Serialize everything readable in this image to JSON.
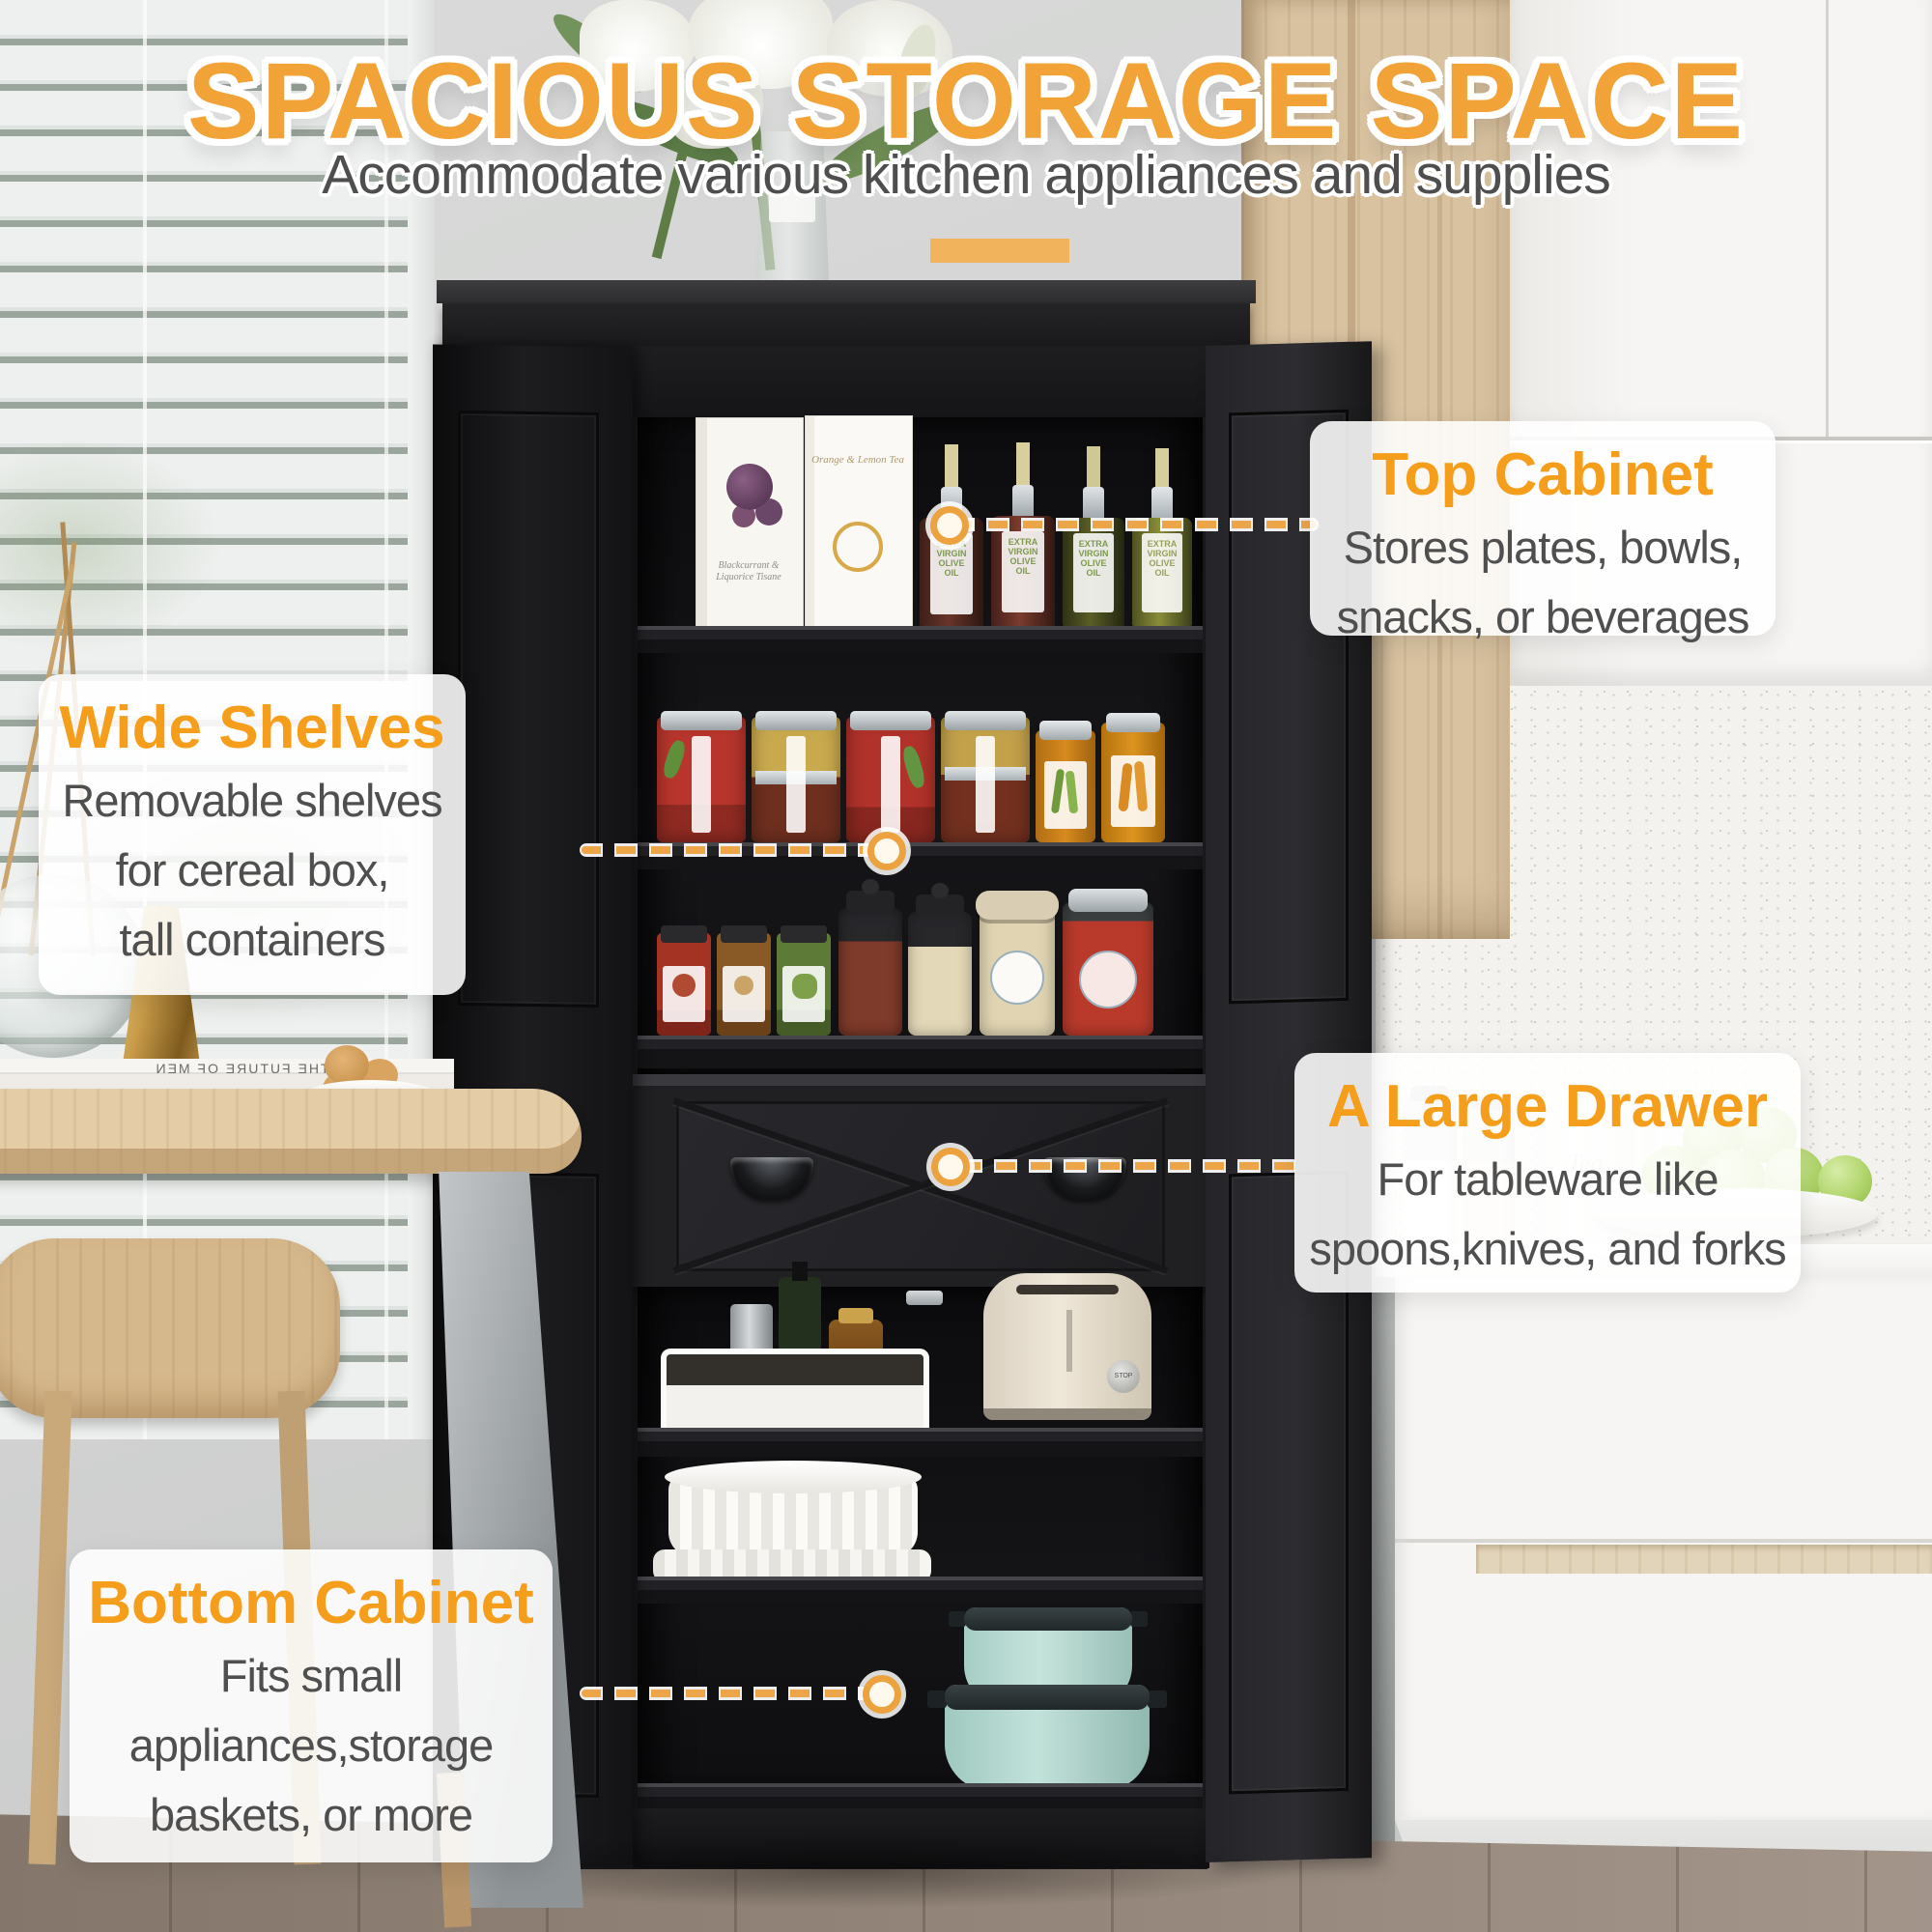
{
  "header": {
    "title": "SPACIOUS STORAGE SPACE",
    "subtitle": "Accommodate various kitchen appliances and supplies"
  },
  "callouts": {
    "top_cabinet": {
      "title": "Top Cabinet",
      "lines": [
        "Stores plates, bowls,",
        "snacks, or beverages"
      ]
    },
    "wide_shelves": {
      "title": "Wide Shelves",
      "lines": [
        "Removable shelves",
        "for cereal box,",
        "tall containers"
      ]
    },
    "large_drawer": {
      "title": "A Large Drawer",
      "lines": [
        "For tableware like",
        "spoons,knives, and forks"
      ]
    },
    "bottom_cabinet": {
      "title": "Bottom Cabinet",
      "lines": [
        "Fits small",
        "appliances,storage",
        "baskets, or more"
      ]
    }
  },
  "products": {
    "olive_oil_label": "EXTRA VIRGIN OLIVE OIL",
    "tea_box_left": "Blackcurrant & Liquorice Tisane",
    "tea_box_right": "Orange & Lemon Tea",
    "book_spine": "THE FUTURE OF MEN",
    "tin_left": "Tea",
    "tin_right": "Coffee",
    "toaster_dial": "STOP"
  },
  "colors": {
    "accent_orange": "#F5A42C",
    "bar_orange": "#F1B35C",
    "body_text": "#4F4F4F",
    "cabinet_black": "#1B1B1E",
    "node_ring": "#EBA23F",
    "mint_pot": "#BFE0D8"
  }
}
